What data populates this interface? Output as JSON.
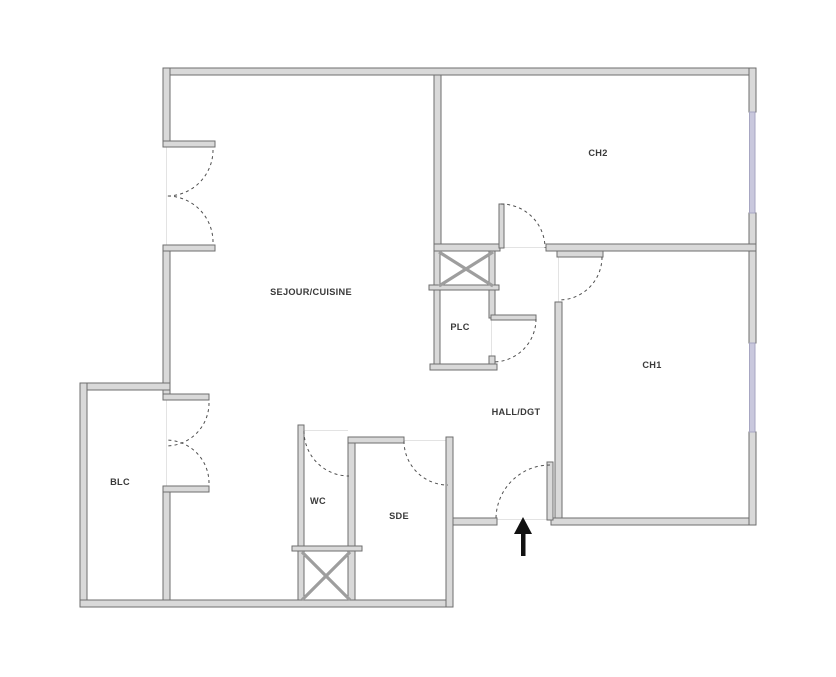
{
  "page": {
    "kind": "apartment-floor-plan",
    "background": "#ffffff"
  },
  "colors": {
    "wall_fill": "#d9d9d9",
    "wall_stroke": "#6e6e6e",
    "window": "#c9c8dd",
    "window_stroke": "#a7a6c2",
    "door_arc": "#4f4f4f",
    "threshold": "#e3e3e3",
    "shaft_line": "#9e9e9e",
    "label_text": "#3a3a3a",
    "arrow": "#111111"
  },
  "rooms": {
    "sejour": {
      "label": "SEJOUR/CUISINE"
    },
    "ch2": {
      "label": "CH2"
    },
    "ch1": {
      "label": "CH1"
    },
    "plc": {
      "label": "PLC"
    },
    "hall": {
      "label": "HALL/DGT"
    },
    "blc": {
      "label": "BLC"
    },
    "wc": {
      "label": "WC"
    },
    "sde": {
      "label": "SDE"
    }
  },
  "features": {
    "windows": [
      "window-ch2-east",
      "window-ch1-east"
    ],
    "doors": [
      "french-door-sejour-west",
      "french-door-blc",
      "door-ch2",
      "door-ch1",
      "door-plc",
      "door-wc",
      "door-sde",
      "entrance-door"
    ],
    "shafts": [
      "duct-shaft-upper",
      "duct-shaft-lower"
    ],
    "entrance_marker": "entrance-arrow"
  }
}
